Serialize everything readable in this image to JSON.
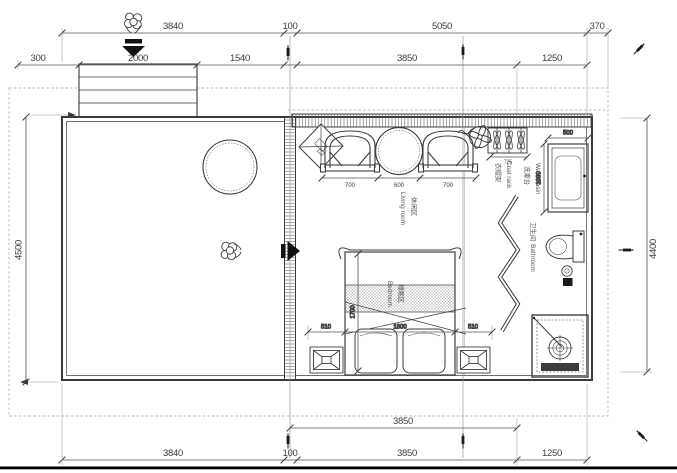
{
  "drawing_type": "floor-plan",
  "colors": {
    "line": "#3a3a3a",
    "dim": "#555555",
    "text": "#3c3c3c",
    "dashed_boundary": "#b8b8b8",
    "solid_black": "#111111",
    "background": "#ffffff"
  },
  "rooms": {
    "living": {
      "zh": "休闲区",
      "en": "Living room"
    },
    "bedroom": {
      "zh": "睡眠区",
      "en": "Bedroom"
    },
    "bathroom": {
      "zh": "卫生间",
      "en": "Bathroom"
    },
    "washbasin": {
      "zh": "洗漱台",
      "en": "Washbasin"
    },
    "coatrack": {
      "zh": "衣帽架",
      "en": "Coat rack"
    }
  },
  "dims": {
    "top_outer": {
      "a": "3840",
      "b": "100",
      "c": "5050",
      "d": "370"
    },
    "top_inner": {
      "a": "300",
      "b": "2000",
      "c": "1540",
      "d": "3850",
      "e": "1250"
    },
    "side_left": "4500",
    "side_right": "4400",
    "bottom_inner": "3850",
    "bottom_outer": {
      "a": "3840",
      "b": "100",
      "c": "3850",
      "d": "1250"
    },
    "lounge": {
      "chair_left": "700",
      "table": "600",
      "chair_right": "700"
    },
    "coat_rack_width": "725",
    "washbasin": {
      "width": "500",
      "depth": "1000"
    },
    "bed": {
      "margin_left": "510",
      "width": "1800",
      "margin_right": "510",
      "length": "1700"
    }
  },
  "icons": {
    "person": "person-pushing-icon",
    "arrow_down": "entry-arrow-down-icon",
    "arrow_right": "entry-arrow-right-icon",
    "fan": "ceiling-fan-icon",
    "pen": "pen-marker-icon",
    "hanger": "clothes-hanger-icon",
    "drain": "shower-drain-icon"
  }
}
